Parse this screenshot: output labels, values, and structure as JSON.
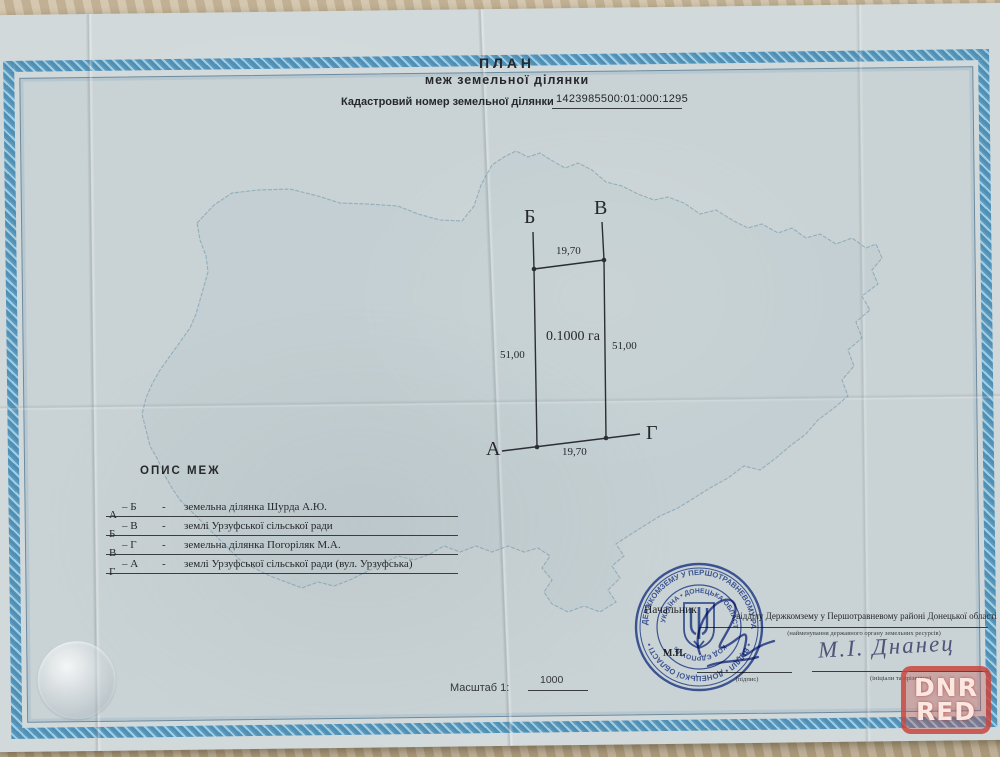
{
  "page": {
    "title_line1": "ПЛАН",
    "title_line2": "меж земельної ділянки",
    "cadastral": {
      "label": "Кадастровий номер земельної ділянки",
      "number": "1423985500:01:000:1295"
    },
    "plot": {
      "corner_tl": "Б",
      "corner_tr": "В",
      "corner_bl": "А",
      "corner_br": "Г",
      "len_top": "19,70",
      "len_bottom": "19,70",
      "len_left": "51,00",
      "len_right": "51,00",
      "area": "0.1000 га"
    },
    "boundaries": {
      "heading": "ОПИС МЕЖ",
      "rows": [
        {
          "from": "А",
          "to": "– Б",
          "dash": "-",
          "desc": "земельна ділянка Шурда А.Ю."
        },
        {
          "from": "Б",
          "to": "– В",
          "dash": "-",
          "desc": "землі Урзуфської сільської ради"
        },
        {
          "from": "В",
          "to": "– Г",
          "dash": "-",
          "desc": "земельна ділянка Погоріляк М.А."
        },
        {
          "from": "Г",
          "to": "– А",
          "dash": "-",
          "desc": "землі Урзуфської сільської ради (вул. Урзуфська)"
        }
      ]
    },
    "approval": {
      "position": "Начальник",
      "org": "відділу Держкомзему у Першотравневому районі Донецької області",
      "org_note": "(найменування державного органу земельних ресурсів)",
      "mp": "М.П.",
      "sig_note": "(підпис)",
      "name": "М.І. Днанец",
      "name_note": "(ініціали та прізвище)"
    },
    "scale": {
      "label": "Масштаб 1:",
      "value": "1000"
    },
    "stamp": {
      "outer_top": "ДЕРЖКОМЗЕМУ У ПЕРШОТРАВНЕВОМУ РАЙОНІ",
      "outer_bottom": "• ВІДДІЛ • ДОНЕЦЬКОЇ ОБЛАСТІ •",
      "inner_top": "УКРАЇНА • ДОНЕЦЬКА ОБЛАСТЬ",
      "inner_bottom": "КОД ЄДРПОУ №"
    },
    "watermark": {
      "line1": "DNR",
      "line2": "RED"
    },
    "colors": {
      "stamp_blue": "#3150a4",
      "border_blue": "#5b98bd",
      "watermark_red": "#c9473d",
      "ink": "#26282b",
      "signature_blue": "#3b4fa6",
      "map_outline": "#6991a5"
    }
  }
}
